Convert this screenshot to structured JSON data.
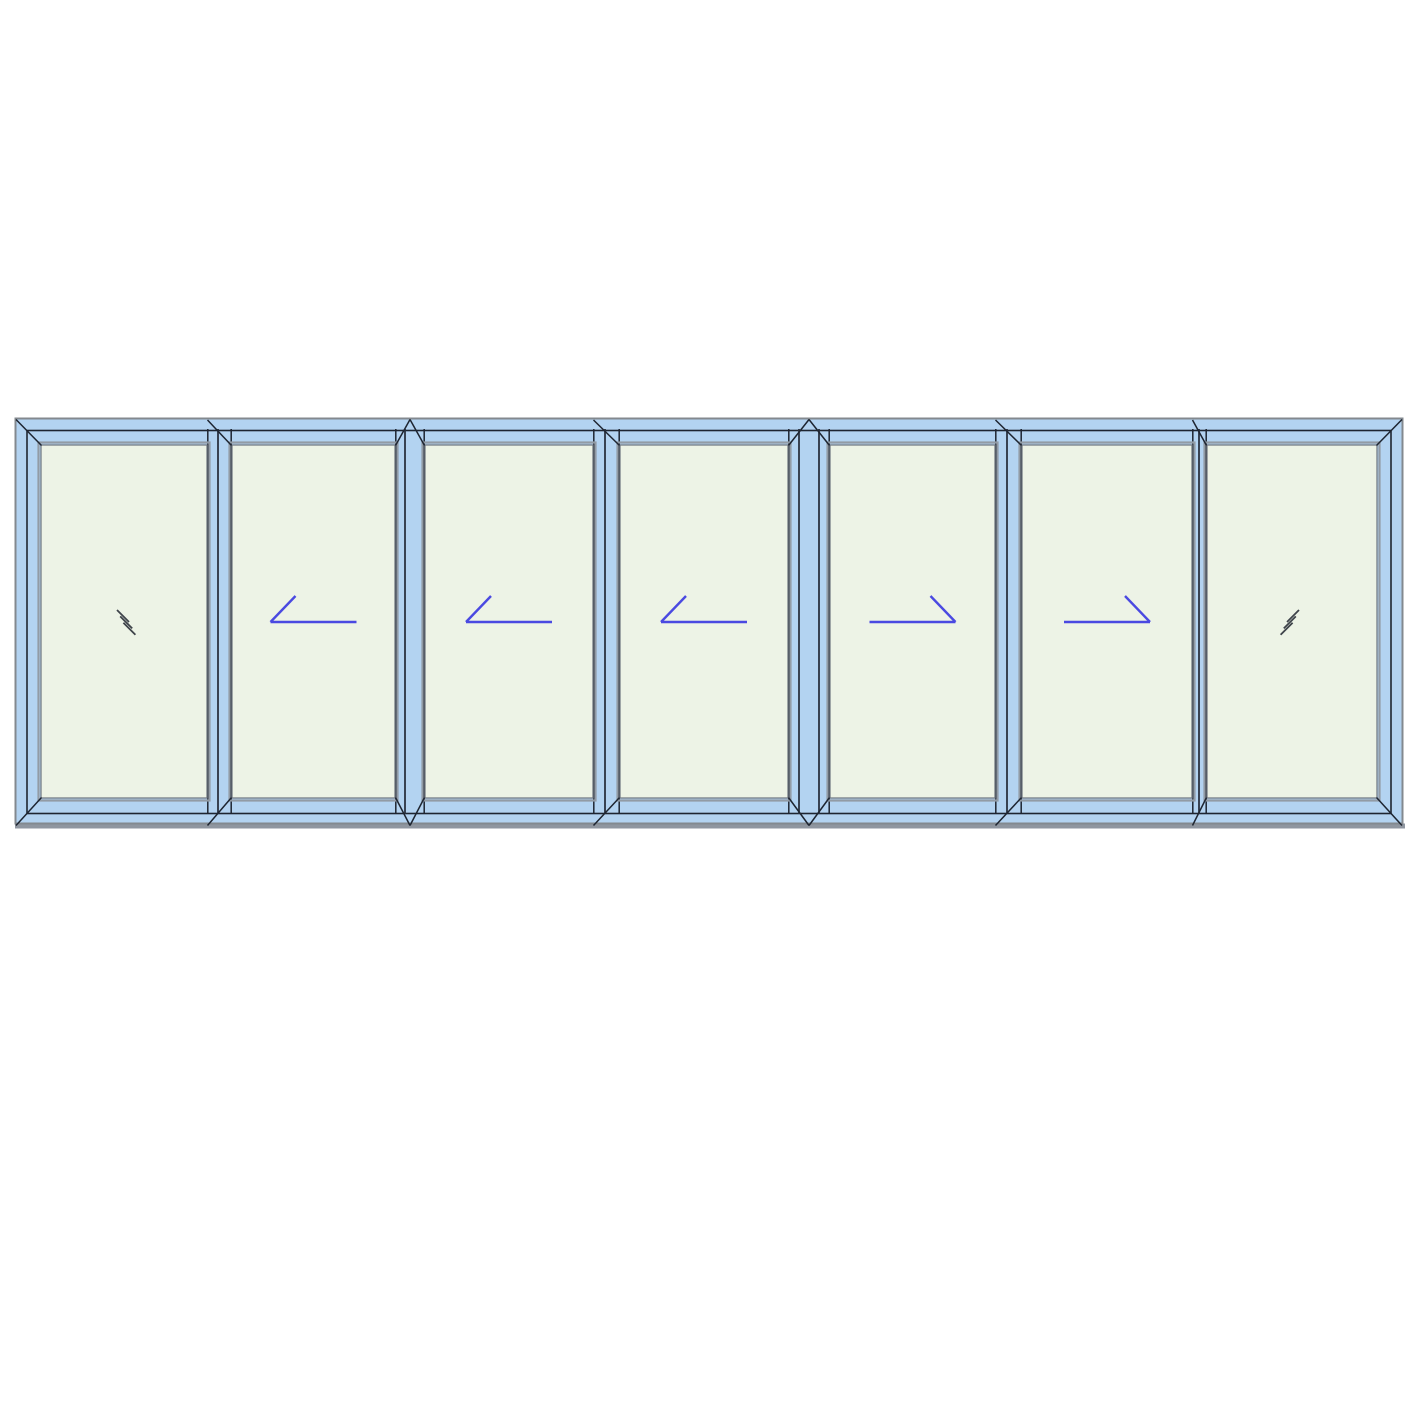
{
  "canvas": {
    "width": 1417,
    "height": 1417,
    "background": "#ffffff"
  },
  "drawing": {
    "type": "window-elevation",
    "description": "seven-panel-sliding-window-elevation",
    "assembly": {
      "x": 15,
      "y": 418,
      "width": 1388,
      "height": 410
    },
    "frame_inner_inset": 12,
    "glass_top": 445,
    "glass_bottom": 798,
    "bead_offset": 2.5,
    "colors": {
      "frame_blue": "#b3d3f1",
      "outline_dark": "#1e2531",
      "outline_gray": "#83898f",
      "divider_inner": "#2a3240",
      "bead_gray": "#929ba5",
      "glass_line": "#757c85",
      "glass": "#edf3e6",
      "arrow": "#4a49e1",
      "hash": "#3e434a",
      "sill_shadow": "#8f96a0"
    },
    "panels": [
      {
        "index": 1,
        "kind": "fixed",
        "symbol": "hash-back",
        "glass_x": 41,
        "glass_w": 166
      },
      {
        "index": 2,
        "kind": "slides-left",
        "symbol": "arrow-left",
        "glass_x": 232,
        "glass_w": 163
      },
      {
        "index": 3,
        "kind": "slides-left",
        "symbol": "arrow-left",
        "glass_x": 425,
        "glass_w": 168
      },
      {
        "index": 4,
        "kind": "slides-left",
        "symbol": "arrow-left",
        "glass_x": 620,
        "glass_w": 168
      },
      {
        "index": 5,
        "kind": "slides-right",
        "symbol": "arrow-right",
        "glass_x": 830,
        "glass_w": 165
      },
      {
        "index": 6,
        "kind": "slides-right",
        "symbol": "arrow-right",
        "glass_x": 1022,
        "glass_w": 170
      },
      {
        "index": 7,
        "kind": "fixed",
        "symbol": "hash-forward",
        "glass_x": 1207,
        "glass_w": 170
      }
    ],
    "dividers": [
      {
        "x": 207,
        "width": 25,
        "joint": "interlock",
        "lines": [
          11
        ]
      },
      {
        "x": 395,
        "width": 30,
        "joint": "unit",
        "lines": [
          10
        ]
      },
      {
        "x": 593,
        "width": 27,
        "joint": "interlock",
        "lines": [
          12
        ]
      },
      {
        "x": 788,
        "width": 42,
        "joint": "unit",
        "lines": [
          11,
          31
        ]
      },
      {
        "x": 995,
        "width": 27,
        "joint": "interlock",
        "lines": [
          12
        ]
      },
      {
        "x": 1192,
        "width": 15,
        "joint": "interlock",
        "lines": [
          7
        ]
      }
    ],
    "symbol_style": {
      "symbol_y": 622,
      "arrow_halfspan": 43,
      "arrow_diag_dx": 25,
      "arrow_diag_dy": 26,
      "arrow_stroke_width": 2.4,
      "hash_len": 12,
      "hash_shift_x": 3.2,
      "hash_shift_y": 6.4,
      "hash_stroke_width": 1.8
    }
  }
}
